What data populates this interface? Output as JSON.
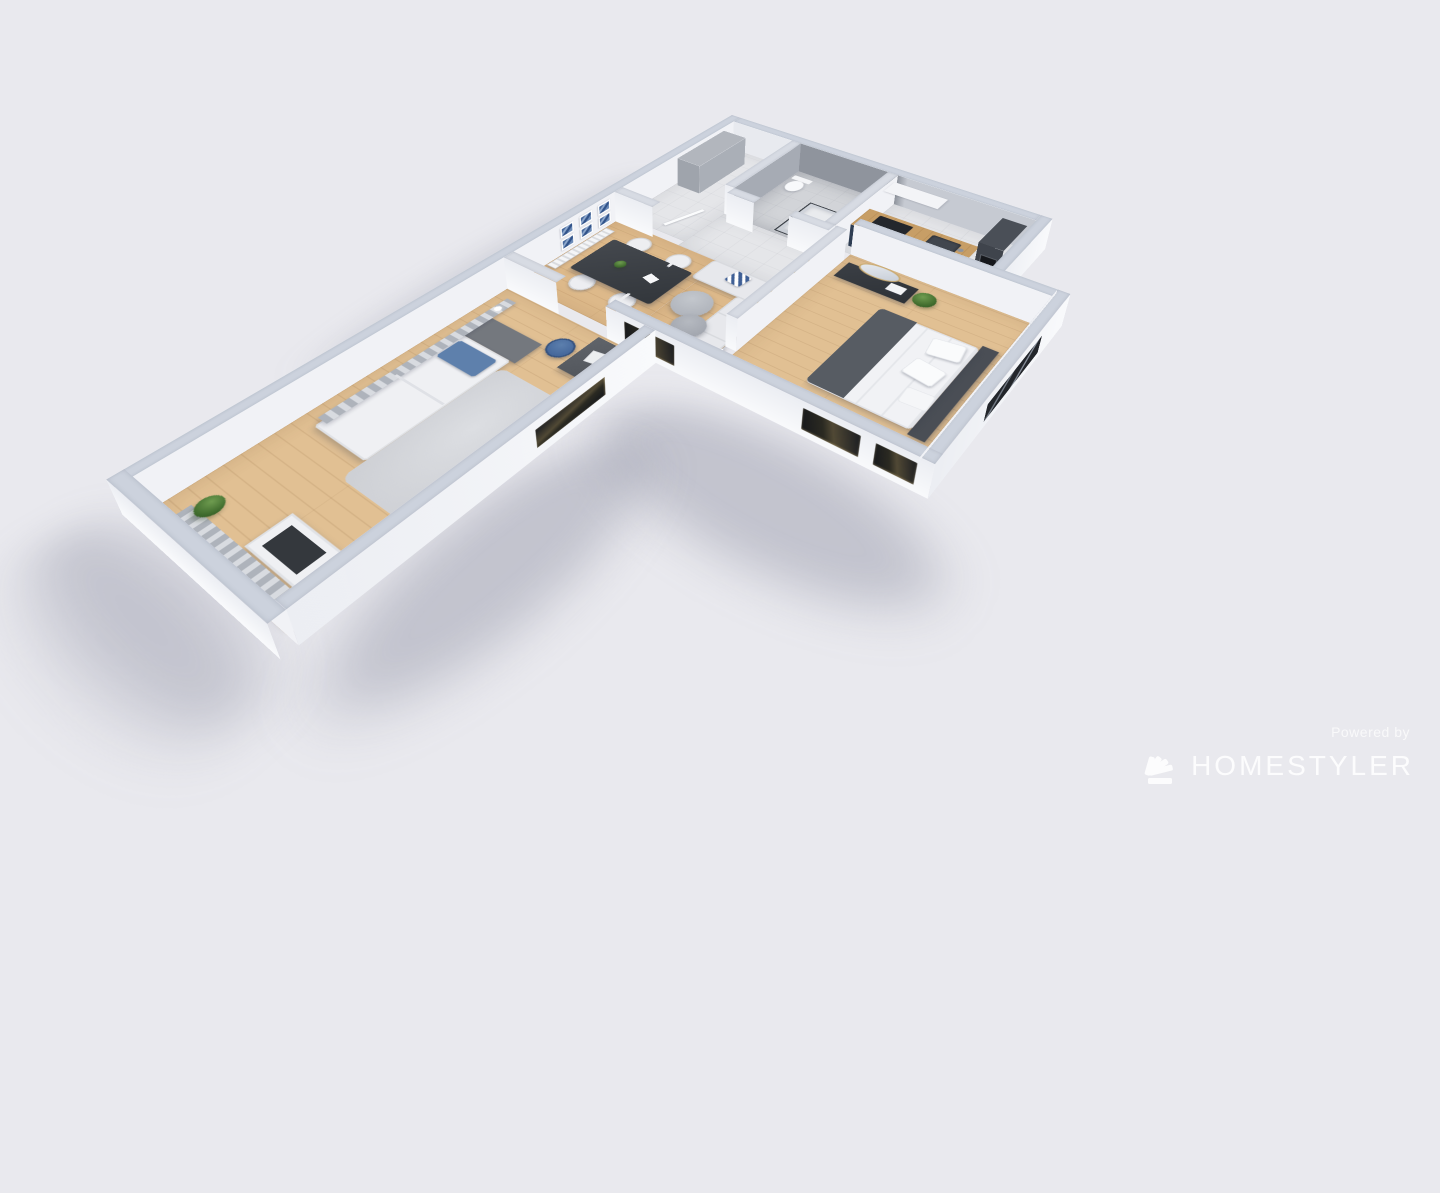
{
  "canvas": {
    "width": 1440,
    "height": 810,
    "background": "#e9e9ee"
  },
  "watermark": {
    "powered_by": "Powered by",
    "brand": "HOMESTYLER",
    "logo": "homestyler-fan-logo"
  },
  "palette": {
    "background": "#e9e9ee",
    "wall_cap": "#ccd2dd",
    "wall_face_light": "#f6f7f9",
    "wall_face_shadow": "#8f949d",
    "tile_floor": "#e5e6e9",
    "wood_floor": "#ddb98a",
    "kitchen_cabinet_navy": "#2e3d52",
    "counter_wood": "#c79e66",
    "sofa_gray": "#e7e8ec",
    "accent_blue": "#4a6da3",
    "curtain_gray": "#aeb3bb",
    "dark_furniture": "#34383e",
    "plant_green": "#4c7a38",
    "mirror_gold": "#c9a96d",
    "rug_gray": "#d2d4d8",
    "window_glow": "#514935"
  },
  "scene": {
    "type": "3d-floorplan-render",
    "view": "isometric-top-orbit",
    "rooms": [
      {
        "name": "entry-hall",
        "floor": "tile",
        "objects": [
          "tall-wardrobe",
          "open-door-leaf"
        ]
      },
      {
        "name": "bathroom",
        "floor": "tile-dark",
        "objects": [
          "glass-shower",
          "toilet"
        ]
      },
      {
        "name": "kitchen",
        "floor": "tile",
        "objects": [
          "navy-counter-wood-top",
          "cooktop",
          "sink",
          "wood-shelf-with-bottles",
          "white-upper-cabinets",
          "tall-oven-column"
        ]
      },
      {
        "name": "dining-area",
        "floor": "wood",
        "objects": [
          "dark-dining-table",
          "chair",
          "chair",
          "chair",
          "chair",
          "table-plant",
          "napkin",
          "radiator",
          "gallery-wall-6-blue-frames"
        ]
      },
      {
        "name": "living-room",
        "floor": "wood",
        "objects": [
          "l-shaped-sofa",
          "chevron-pillow",
          "white-pillow",
          "round-pouf-large",
          "round-pouf-small",
          "blue-curtain",
          "floor-plant",
          "sphere-floor-lamp",
          "gold-oval-mirror",
          "gold-oval-mirror"
        ]
      },
      {
        "name": "master-bedroom",
        "floor": "wood",
        "objects": [
          "double-bed",
          "dark-headboard",
          "dark-blanket",
          "pillows",
          "dark-dresser",
          "oval-mirror",
          "plant",
          "stacked-books",
          "round-fan-wall-decor",
          "floor-lamp",
          "blue-curtain",
          "windows"
        ]
      },
      {
        "name": "study-bedroom-wing",
        "floor": "wood",
        "objects": [
          "single-bed",
          "blue-pillow",
          "dark-accent-panel",
          "gray-rug",
          "desk",
          "laptop",
          "blue-chair",
          "desk-plant",
          "radiator",
          "slat-curtains-west",
          "slat-curtains-south",
          "white-cabinet",
          "tv-panel",
          "corner-plant",
          "window"
        ]
      }
    ]
  }
}
